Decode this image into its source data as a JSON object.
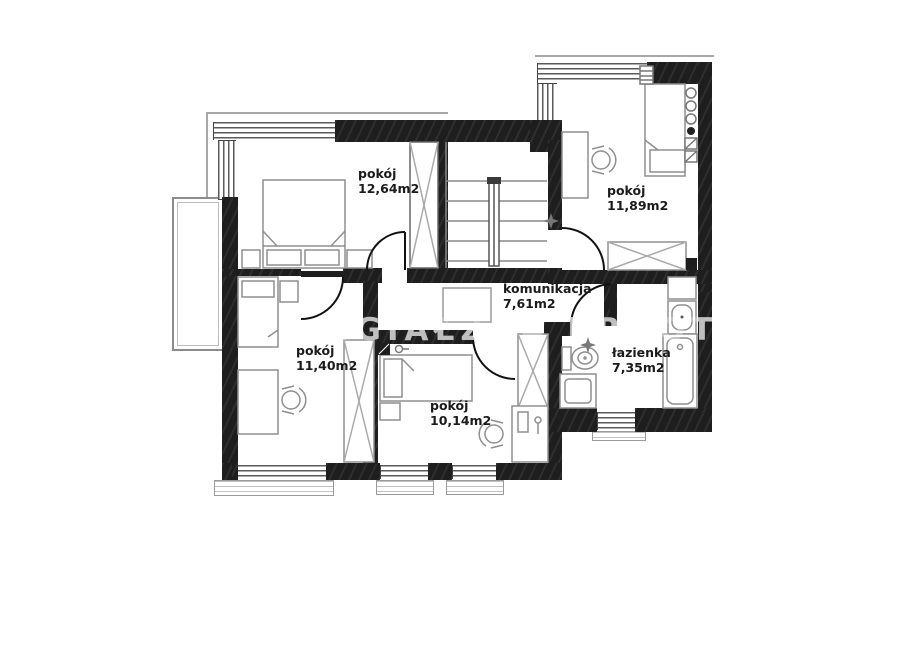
{
  "plan": {
    "rooms": [
      {
        "name": "pokój",
        "area": "12,64m2"
      },
      {
        "name": "pokój",
        "area": "11,89m2"
      },
      {
        "name": "komunikacja",
        "area": "7,61m2"
      },
      {
        "name": "pokój",
        "area": "11,40m2"
      },
      {
        "name": "pokój",
        "area": "10,14m2"
      },
      {
        "name": "łazienka",
        "area": "7,35m2"
      }
    ],
    "watermark": {
      "text": "IGIAŁZOA BROOT"
    },
    "colors": {
      "wall": "#1e1e1e",
      "furniture_outline": "#8f8f8f",
      "door_arc": "#111111",
      "watermark": "#bfbfbf",
      "background": "#ffffff"
    }
  }
}
